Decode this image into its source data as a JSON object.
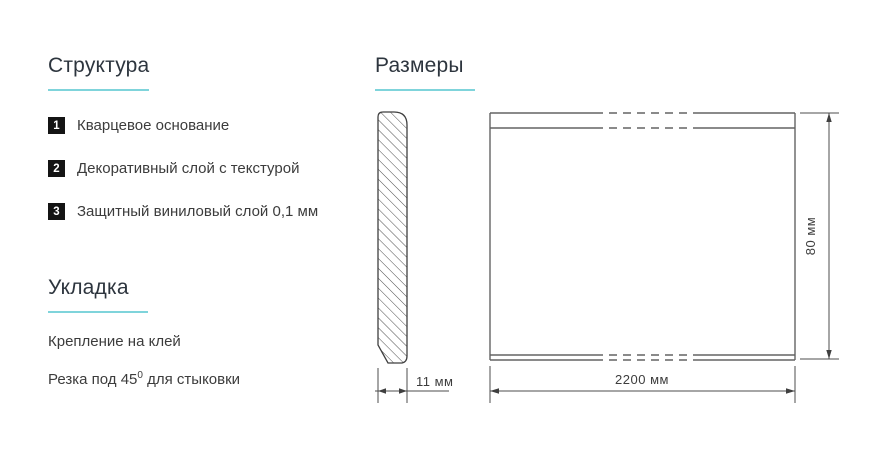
{
  "accent_color": "#7fd4db",
  "structure": {
    "title": "Структура",
    "items": [
      {
        "num": "1",
        "label": "Кварцевое основание"
      },
      {
        "num": "2",
        "label": "Декоративный слой с текстурой"
      },
      {
        "num": "3",
        "label": "Защитный виниловый слой 0,1 мм"
      }
    ]
  },
  "installation": {
    "title": "Укладка",
    "glue_line": "Крепление на клей",
    "cut_prefix": "Резка под 45",
    "cut_sup": "0",
    "cut_suffix": " для стыковки"
  },
  "dimensions": {
    "title": "Размеры",
    "thickness_label": "11 мм",
    "length_label": "2200 мм",
    "height_label": "80 мм"
  }
}
